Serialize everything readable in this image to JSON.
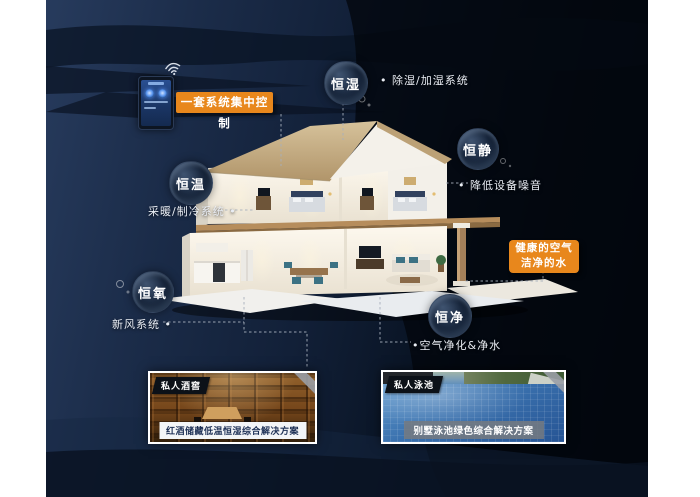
{
  "scene": {
    "control_label": "一套系统集中控制",
    "highlight": {
      "line1": "健康的空气",
      "line2": "洁净的水"
    },
    "bubbles": {
      "humidity": {
        "label": "恒湿",
        "note": "• 除湿/加湿系统"
      },
      "quiet": {
        "label": "恒静",
        "note": "• 降低设备噪音"
      },
      "temperature": {
        "label": "恒温",
        "note": "采暖/制冷系统 •"
      },
      "oxygen": {
        "label": "恒氧",
        "note": "新风系统 •"
      },
      "clean": {
        "label": "恒净",
        "note": "•空气净化&净水"
      }
    },
    "cards": {
      "wine": {
        "badge": "私人酒窖",
        "caption": "红酒储藏低温恒湿综合解决方案"
      },
      "pool": {
        "badge": "私人泳池",
        "caption": "别墅泳池绿色综合解决方案"
      }
    },
    "colors": {
      "accent_orange": "#e8871c",
      "canvas_navy": "#14223a",
      "label_text": "#ffffff"
    }
  }
}
